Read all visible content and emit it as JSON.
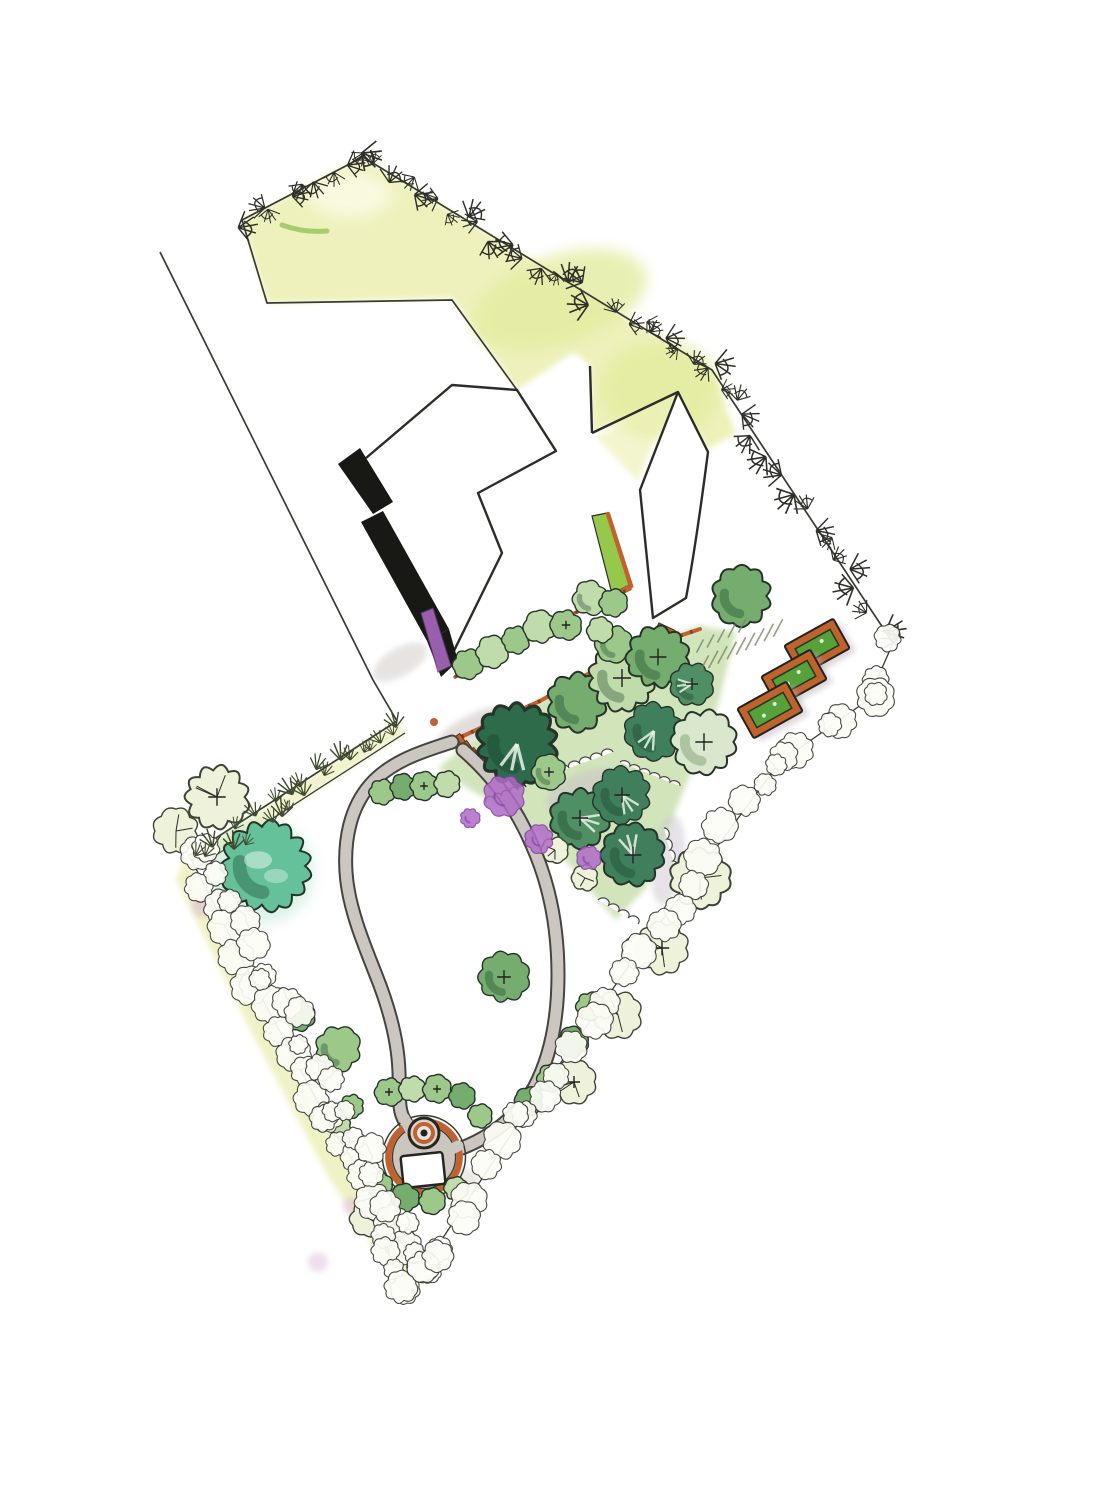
{
  "document": {
    "type": "landscape garden design site plan",
    "medium": "hand-drawn ink and watercolor, scanned",
    "view": "top-down plan",
    "visible_text": "none"
  },
  "palette": {
    "paper": "#ffffff",
    "ink": "#2c2c28",
    "boundary_line": "#3a3a34",
    "lawn_wash": "#eef1b8",
    "lawn_wash_deep": "#e3eca0",
    "hedge_wash": "#edf0bb",
    "grove_wash": "#c2dca4",
    "tree_light": "#9cc98a",
    "tree_lighter": "#c0dcaa",
    "tree_med": "#74ad6d",
    "tree_meddark": "#4e8f63",
    "tree_dark": "#3f7f5c",
    "tree_darkest": "#2e6b4a",
    "tree_mint": "#d9e8cc",
    "tree_pale": "#eef2da",
    "tree_teal": "#64c198",
    "purple": "#b06cc8",
    "purple_dark": "#7b3fa0",
    "pink_wash": "#dcb8d8",
    "orange": "#c0622e",
    "orange_dark": "#8a3f1c",
    "bed_green": "#57a03a",
    "strip_green": "#96c94b",
    "path_gray": "#ccc6c1",
    "path_edge": "#45443e",
    "shadow_black": "#181815",
    "warm_gray": "#cfc7c9",
    "hatch_gray": "#7c8468",
    "highlight": "#ecf4e6"
  },
  "features": {
    "property_boundary": "irregular pentagon plot rotated diagonally",
    "building": "white stepped house footprint with black cast-shadow on west walls",
    "upper_lawn": "yellow-green watercolor lawn inside north boundary hedge",
    "entrance_passage": "white walkway between house wings with planted strip and steps",
    "grove": "cluster of round watercolor trees with purple flowering shrubs",
    "loop_path": "gray looping footpath enclosing lower lawn",
    "fire_pit_patio": "circular terracotta-edged patio with fire pit and white bench",
    "raised_beds_count": 3,
    "parking": "hatched gravel strokes near raised beds",
    "hedges": "scribbled shrub lines along all boundaries"
  },
  "plan": {
    "trees": [
      [
        700,
        878,
        27,
        "pale"
      ],
      [
        662,
        948,
        24,
        "pale"
      ],
      [
        618,
        1015,
        22,
        "pale"
      ],
      [
        574,
        1082,
        20,
        "pale"
      ],
      [
        368,
        1218,
        17,
        "pale"
      ],
      [
        398,
        1240,
        15,
        "pale"
      ],
      [
        217,
        797,
        29,
        "pale"
      ],
      [
        176,
        831,
        21,
        "pale"
      ],
      [
        517,
        744,
        36,
        "darkest"
      ],
      [
        549,
        772,
        16,
        "light"
      ],
      [
        577,
        702,
        27,
        "med"
      ],
      [
        622,
        678,
        30,
        "lighter"
      ],
      [
        614,
        644,
        17,
        "light"
      ],
      [
        658,
        657,
        28,
        "med"
      ],
      [
        692,
        684,
        20,
        "meddark"
      ],
      [
        654,
        731,
        26,
        "dark"
      ],
      [
        704,
        742,
        29,
        "mint"
      ],
      [
        580,
        818,
        27,
        "meddark"
      ],
      [
        622,
        795,
        26,
        "dark"
      ],
      [
        633,
        855,
        28,
        "dark"
      ],
      [
        555,
        850,
        12,
        "pale"
      ],
      [
        585,
        878,
        12,
        "pale"
      ],
      [
        382,
        792,
        12,
        "light"
      ],
      [
        403,
        787,
        12,
        "med"
      ],
      [
        424,
        786,
        13,
        "light"
      ],
      [
        447,
        784,
        12,
        "lighter"
      ],
      [
        468,
        664,
        14,
        "light"
      ],
      [
        492,
        652,
        15,
        "lighter"
      ],
      [
        516,
        640,
        13,
        "light"
      ],
      [
        540,
        627,
        15,
        "lighter"
      ],
      [
        566,
        625,
        14,
        "light"
      ],
      [
        590,
        598,
        16,
        "lighter"
      ],
      [
        613,
        603,
        13,
        "light"
      ],
      [
        600,
        630,
        12,
        "lighter"
      ],
      [
        742,
        596,
        27,
        "med"
      ],
      [
        504,
        977,
        23,
        "med"
      ],
      [
        266,
        866,
        40,
        "teal"
      ],
      [
        300,
        1016,
        14,
        "med"
      ],
      [
        338,
        1049,
        21,
        "light"
      ],
      [
        590,
        1006,
        13,
        "light"
      ],
      [
        573,
        1042,
        14,
        "med"
      ],
      [
        551,
        1078,
        13,
        "light"
      ],
      [
        529,
        1101,
        13,
        "med"
      ],
      [
        389,
        1092,
        13,
        "light"
      ],
      [
        412,
        1089,
        12,
        "lighter"
      ],
      [
        437,
        1089,
        13,
        "light"
      ],
      [
        462,
        1096,
        12,
        "med"
      ],
      [
        352,
        1106,
        11,
        "light"
      ],
      [
        340,
        1126,
        10,
        "lighter"
      ],
      [
        480,
        1116,
        11,
        "light"
      ],
      [
        379,
        1184,
        12,
        "light"
      ],
      [
        405,
        1198,
        13,
        "med"
      ],
      [
        432,
        1201,
        12,
        "light"
      ],
      [
        456,
        1189,
        11,
        "lighter"
      ]
    ],
    "purple": [
      [
        504,
        796,
        19
      ],
      [
        539,
        839,
        13
      ],
      [
        589,
        858,
        11
      ],
      [
        470,
        818,
        9
      ]
    ],
    "hedges": [
      {
        "type": "sprig",
        "step": 17,
        "s": 1.0,
        "pts": [
          [
            242,
            220
          ],
          [
            363,
            157
          ],
          [
            712,
            370
          ]
        ]
      },
      {
        "type": "sprig",
        "step": 20,
        "s": 1.05,
        "pts": [
          [
            712,
            370
          ],
          [
            893,
            643
          ]
        ]
      },
      {
        "type": "scallop",
        "step": 30,
        "s": 1.0,
        "pts": [
          [
            893,
            643
          ],
          [
            868,
            700
          ],
          [
            780,
            762
          ],
          [
            640,
            950
          ],
          [
            522,
            1118
          ],
          [
            423,
            1268
          ]
        ]
      },
      {
        "type": "scallop",
        "step": 26,
        "s": 1.1,
        "pts": [
          [
            190,
            857
          ],
          [
            252,
            980
          ],
          [
            326,
            1120
          ],
          [
            420,
            1265
          ]
        ]
      },
      {
        "type": "scallop",
        "step": 28,
        "s": 0.9,
        "pts": [
          [
            208,
            852
          ],
          [
            268,
            972
          ],
          [
            340,
            1110
          ],
          [
            416,
            1248
          ]
        ]
      },
      {
        "type": "scallop",
        "step": 20,
        "s": 0.9,
        "pts": [
          [
            380,
            1240
          ],
          [
            408,
            1288
          ],
          [
            440,
            1250
          ]
        ]
      },
      {
        "type": "tuft",
        "step": 24,
        "s": 1.0,
        "pts": [
          [
            397,
            724
          ],
          [
            300,
            790
          ],
          [
            196,
            862
          ]
        ]
      },
      {
        "type": "tuft",
        "step": 26,
        "s": 0.9,
        "pts": [
          [
            390,
            735
          ],
          [
            290,
            812
          ],
          [
            205,
            862
          ]
        ]
      }
    ],
    "beds": {
      "rot": -29,
      "w": 56,
      "h": 34,
      "items": [
        [
          817,
          647
        ],
        [
          794,
          678
        ],
        [
          770,
          710
        ]
      ]
    },
    "hatch": [
      {
        "a": [
          704,
          664
        ],
        "b": [
          778,
          628
        ],
        "n": 9,
        "len": 20,
        "ang": -62
      },
      {
        "a": [
          700,
          646
        ],
        "b": [
          742,
          626
        ],
        "n": 5,
        "len": 15,
        "ang": -62
      }
    ]
  }
}
